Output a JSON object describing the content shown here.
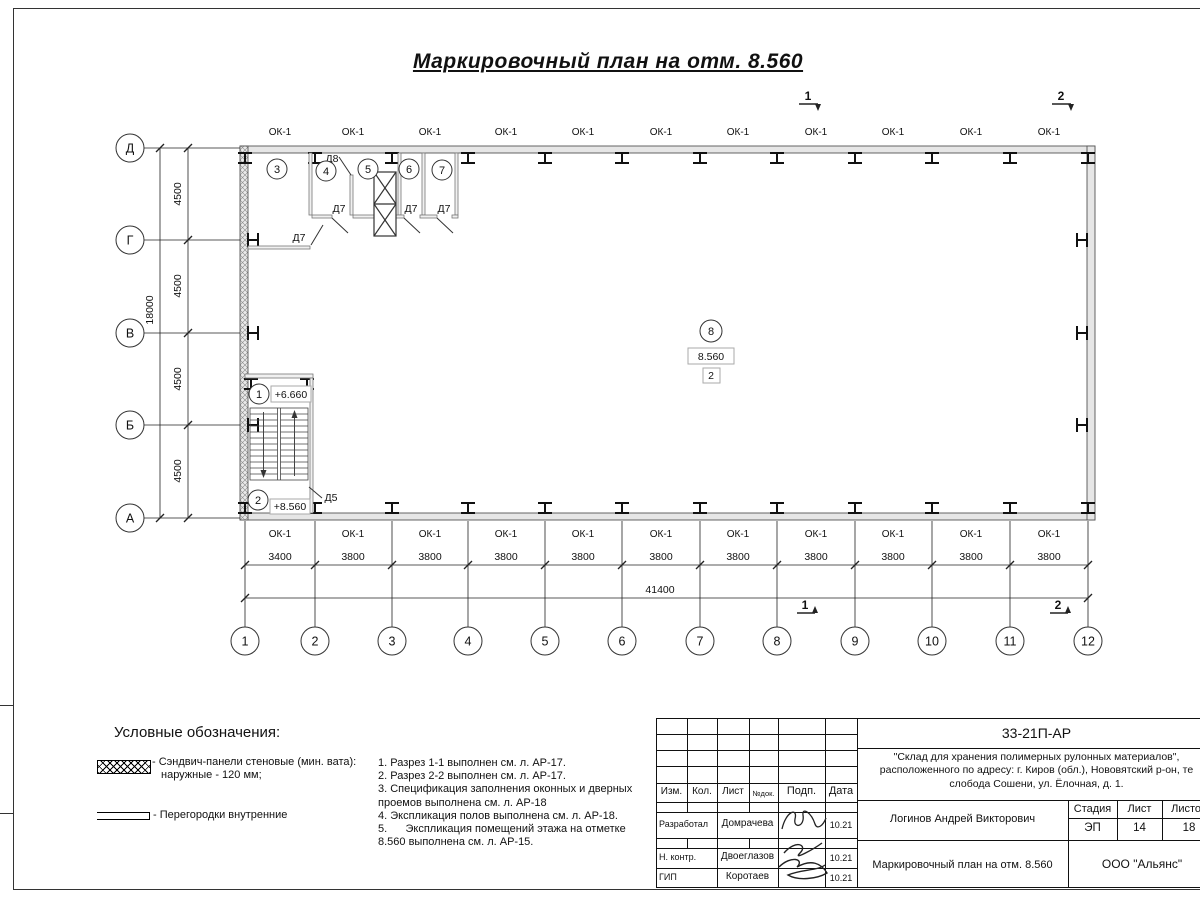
{
  "sheet": {
    "title": "Маркировочный план на отм. 8.560"
  },
  "plan": {
    "window_mark": "ОК-1",
    "col_axes": [
      "1",
      "2",
      "3",
      "4",
      "5",
      "6",
      "7",
      "8",
      "9",
      "10",
      "11",
      "12"
    ],
    "row_axes": [
      "Д",
      "Г",
      "В",
      "Б",
      "А"
    ],
    "bay_dims": [
      "3400",
      "3800",
      "3800",
      "3800",
      "3800",
      "3800",
      "3800",
      "3800",
      "3800",
      "3800",
      "3800"
    ],
    "total_width": "41400",
    "row_dims": [
      "4500",
      "4500",
      "4500",
      "4500"
    ],
    "total_height": "18000",
    "rooms": {
      "r1": "1",
      "r2": "2",
      "r3": "3",
      "r4": "4",
      "r5": "5",
      "r6": "6",
      "r7": "7",
      "r8": "8"
    },
    "levels": {
      "stair_upper": "+6.660",
      "stair_main": "+8.560",
      "floor": "8.560",
      "zone": "2"
    },
    "doors": {
      "d5": "Д5",
      "d7": "Д7",
      "d8": "Д8"
    },
    "sections": {
      "s1": "1",
      "s2": "2"
    }
  },
  "legend": {
    "heading": "Условные обозначения:",
    "item1_line1": "- Сэндвич-панели стеновые (мин. вата):",
    "item1_line2": "наружные - 120 мм;",
    "item2": "- Перегородки внутренние"
  },
  "notes": [
    "1. Разрез 1-1 выполнен см. л. АР-17.",
    "2. Разрез 2-2 выполнен см. л. АР-17.",
    "3. Спецификация заполнения оконных и дверных проемов выполнена см. л. АР-18",
    "4. Экспликация полов выполнена см. л. АР-18.",
    "5.      Экспликация помещений этажа на отметке 8.560 выполнена см. л. АР-15."
  ],
  "titleblock": {
    "doc_code": "33-21П-АР",
    "project_line1": "\"Склад для хранения полимерных рулонных материалов\",",
    "project_line2": "расположенного по адресу: г. Киров (обл.), Нововятский р-он, те",
    "project_line3": "слобода Сошени, ул. Ёлочная, д. 1.",
    "header": {
      "izm": "Изм.",
      "kol": "Кол.",
      "list": "Лист",
      "ndoc": "№док.",
      "podp": "Подп.",
      "data": "Дата"
    },
    "rows": [
      {
        "role": "Разработал",
        "name": "Домрачева",
        "date": "10.21"
      },
      {
        "role": "Н. контр.",
        "name": "Двоеглазов",
        "date": "10.21"
      },
      {
        "role": "ГИП",
        "name": "Коротаев",
        "date": "10.21"
      }
    ],
    "client": "Логинов Андрей Викторович",
    "stage_label": "Стадия",
    "sheet_label": "Лист",
    "sheets_label": "Листов",
    "stage": "ЭП",
    "sheet_no": "14",
    "sheets_total": "18",
    "drawing_title": "Маркировочный план на отм. 8.560",
    "company": "ООО \"Альянс\""
  }
}
